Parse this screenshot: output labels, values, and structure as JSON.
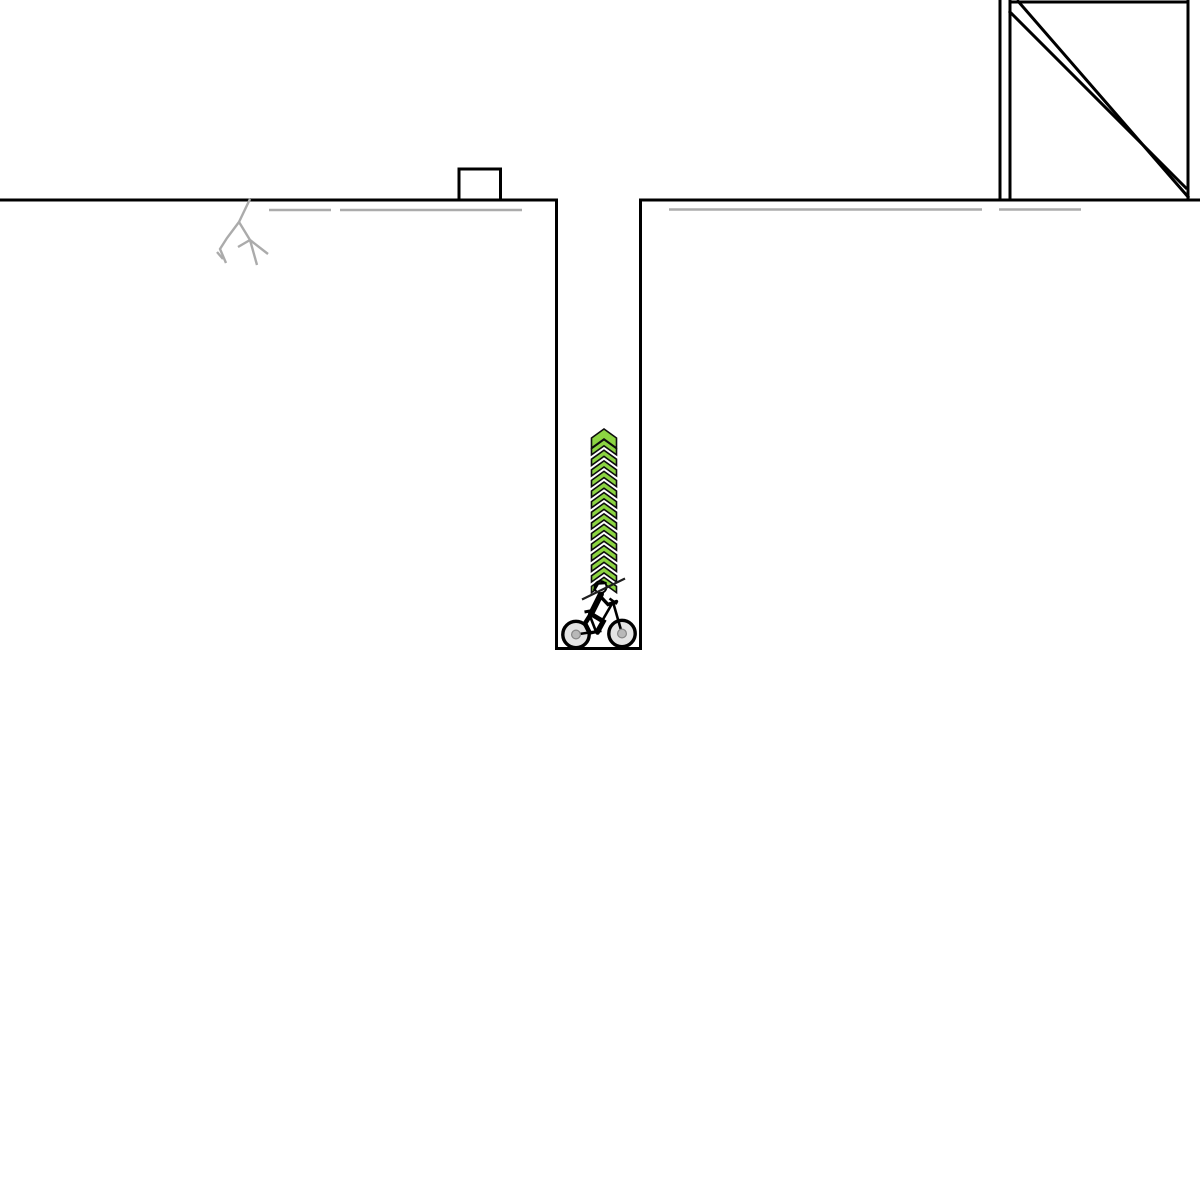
{
  "canvas": {
    "width": 1200,
    "height": 1200,
    "background": "#ffffff"
  },
  "palette": {
    "track_black": "#000000",
    "scenery_gray": "#ababab",
    "boost_green": "#8cd442",
    "boost_outline": "#0d0d0d",
    "wheel_inner": "#e4e4e4",
    "wheel_hub": "#b8b8b8",
    "wheel_hub_ring": "#878787",
    "helmet_white": "#ffffff"
  },
  "scene": {
    "elements": [
      {
        "name": "terrain-ground-and-pit",
        "type": "polyline",
        "points": [
          [
            0,
            200
          ],
          [
            556.5,
            200
          ],
          [
            556.5,
            648.5
          ],
          [
            640.5,
            648.5
          ],
          [
            640.5,
            200
          ],
          [
            1200,
            200
          ]
        ],
        "stroke": "#000000",
        "width": 3
      },
      {
        "name": "obstacle-box",
        "type": "rect",
        "x": 459,
        "y": 169,
        "w": 41.5,
        "h": 31,
        "fill": "#ffffff",
        "stroke": "#000000",
        "width": 3
      },
      {
        "name": "ramp-structure-left-outer-post",
        "type": "polyline",
        "points": [
          [
            1000,
            0
          ],
          [
            1000,
            199
          ]
        ],
        "stroke": "#000000",
        "width": 3
      },
      {
        "name": "ramp-structure-left-inner-post",
        "type": "polyline",
        "points": [
          [
            1010,
            0
          ],
          [
            1010,
            199
          ]
        ],
        "stroke": "#000000",
        "width": 3
      },
      {
        "name": "ramp-structure-right-post",
        "type": "polyline",
        "points": [
          [
            1188,
            0
          ],
          [
            1188,
            199
          ]
        ],
        "stroke": "#000000",
        "width": 3
      },
      {
        "name": "ramp-structure-top-beam",
        "type": "polyline",
        "points": [
          [
            1009,
            2
          ],
          [
            1188,
            2
          ]
        ],
        "stroke": "#000000",
        "width": 3
      },
      {
        "name": "ramp-structure-diagonal-outer",
        "type": "polyline",
        "points": [
          [
            1017,
            0
          ],
          [
            1189,
            198
          ]
        ],
        "stroke": "#000000",
        "width": 3
      },
      {
        "name": "ramp-structure-diagonal-inner",
        "type": "polyline",
        "points": [
          [
            1009,
            11
          ],
          [
            1187,
            189
          ]
        ],
        "stroke": "#000000",
        "width": 3
      },
      {
        "name": "scenery-line-left-a",
        "type": "polyline",
        "points": [
          [
            269,
            210
          ],
          [
            331,
            210
          ]
        ],
        "stroke": "#ababab",
        "width": 2.6
      },
      {
        "name": "scenery-line-left-b",
        "type": "polyline",
        "points": [
          [
            340,
            210
          ],
          [
            522,
            210
          ]
        ],
        "stroke": "#ababab",
        "width": 2.6
      },
      {
        "name": "scenery-line-right-a",
        "type": "polyline",
        "points": [
          [
            669,
            209.5
          ],
          [
            982,
            209.5
          ]
        ],
        "stroke": "#ababab",
        "width": 2.6
      },
      {
        "name": "scenery-line-right-b",
        "type": "polyline",
        "points": [
          [
            999,
            209.5
          ],
          [
            1081,
            209.5
          ]
        ],
        "stroke": "#ababab",
        "width": 2.6
      },
      {
        "name": "scenery-crack-main",
        "type": "polyline",
        "points": [
          [
            250,
            199
          ],
          [
            239,
            222
          ],
          [
            227,
            238
          ],
          [
            220,
            249
          ],
          [
            226,
            263
          ]
        ],
        "stroke": "#ababab",
        "width": 2.4
      },
      {
        "name": "scenery-crack-tick",
        "type": "polyline",
        "points": [
          [
            217,
            252
          ],
          [
            223,
            259
          ]
        ],
        "stroke": "#ababab",
        "width": 2.4
      },
      {
        "name": "scenery-crack-branch",
        "type": "polyline",
        "points": [
          [
            239,
            222
          ],
          [
            250,
            240
          ],
          [
            257,
            265
          ]
        ],
        "stroke": "#ababab",
        "width": 2.4
      },
      {
        "name": "scenery-crack-branch-left",
        "type": "polyline",
        "points": [
          [
            250,
            240
          ],
          [
            238,
            247
          ]
        ],
        "stroke": "#ababab",
        "width": 2.4
      },
      {
        "name": "scenery-crack-branch-right",
        "type": "polyline",
        "points": [
          [
            250,
            240
          ],
          [
            268,
            254
          ]
        ],
        "stroke": "#ababab",
        "width": 2.4
      },
      {
        "name": "boost-arrows",
        "type": "chevron-stack",
        "cx": 604,
        "top": 429,
        "count": 15,
        "period": 10.6,
        "half_width": 12.5,
        "rise": 9,
        "thickness": 6.2,
        "first_thickness": 10,
        "fill": "#8cd442",
        "stroke": "#0d0d0d",
        "stroke_width": 1.6
      },
      {
        "name": "bike-rear-wheel-tire",
        "type": "circle",
        "cx": 576,
        "cy": 634.5,
        "r": 13.2,
        "fill": "#e4e4e4",
        "stroke": "#000000",
        "width": 3.4
      },
      {
        "name": "bike-front-wheel-tire",
        "type": "circle",
        "cx": 622,
        "cy": 633.5,
        "r": 13.2,
        "fill": "#e4e4e4",
        "stroke": "#000000",
        "width": 3.4
      },
      {
        "name": "bike-chainstay-seat-tube",
        "type": "polyline",
        "points": [
          [
            576,
            634.5
          ],
          [
            596,
            631.5
          ],
          [
            589,
            613.5
          ]
        ],
        "stroke": "#000000",
        "width": 2.6
      },
      {
        "name": "bike-down-tube",
        "type": "polyline",
        "points": [
          [
            596,
            631.5
          ],
          [
            613,
            602
          ]
        ],
        "stroke": "#000000",
        "width": 2.6
      },
      {
        "name": "bike-fork",
        "type": "polyline",
        "points": [
          [
            613,
            602
          ],
          [
            622,
            633.5
          ]
        ],
        "stroke": "#000000",
        "width": 2.6
      },
      {
        "name": "bike-handlebar",
        "type": "polyline",
        "points": [
          [
            609.5,
            598.5
          ],
          [
            617,
            604
          ]
        ],
        "stroke": "#000000",
        "width": 2.6
      },
      {
        "name": "bike-seat",
        "type": "polyline",
        "points": [
          [
            584.5,
            612
          ],
          [
            592.5,
            610.5
          ]
        ],
        "stroke": "#000000",
        "width": 3
      },
      {
        "name": "bike-crank",
        "type": "polyline",
        "points": [
          [
            590,
            633.5
          ],
          [
            601.5,
            631
          ]
        ],
        "stroke": "#000000",
        "width": 2.2
      },
      {
        "name": "bike-rear-hub",
        "type": "circle",
        "cx": 576,
        "cy": 634.5,
        "r": 4.4,
        "fill": "#b8b8b8",
        "stroke": "#878787",
        "width": 1.2
      },
      {
        "name": "bike-front-hub",
        "type": "circle",
        "cx": 622,
        "cy": 633.5,
        "r": 4.4,
        "fill": "#b8b8b8",
        "stroke": "#878787",
        "width": 1.2
      },
      {
        "name": "rider-torso",
        "type": "polyline",
        "points": [
          [
            601,
            594
          ],
          [
            591,
            614
          ]
        ],
        "stroke": "#000000",
        "width": 6,
        "cap": "round"
      },
      {
        "name": "rider-arm",
        "type": "polyline",
        "points": [
          [
            600,
            596
          ],
          [
            608,
            604.5
          ],
          [
            616.5,
            601.5
          ]
        ],
        "stroke": "#000000",
        "width": 3.4,
        "cap": "round"
      },
      {
        "name": "rider-front-leg",
        "type": "polyline",
        "points": [
          [
            591,
            614
          ],
          [
            603.5,
            621.5
          ],
          [
            597.5,
            632.5
          ]
        ],
        "stroke": "#000000",
        "width": 4.6,
        "cap": "round"
      },
      {
        "name": "rider-rear-leg",
        "type": "polyline",
        "points": [
          [
            591,
            614
          ],
          [
            585,
            623.5
          ],
          [
            589.5,
            632.5
          ]
        ],
        "stroke": "#000000",
        "width": 4.6,
        "cap": "round"
      },
      {
        "name": "rider-head",
        "type": "circle",
        "cx": 600.5,
        "cy": 587,
        "r": 6,
        "fill": "#ffffff",
        "stroke": "#000000",
        "width": 1.8
      },
      {
        "name": "rider-helmet",
        "type": "polyline",
        "points": [
          [
            594.5,
            589.5
          ],
          [
            598,
            583.5
          ],
          [
            605.5,
            583
          ]
        ],
        "stroke": "#000000",
        "width": 2.6,
        "cap": "round"
      },
      {
        "name": "track-short-diagonal-line",
        "type": "polyline",
        "points": [
          [
            582,
            599.5
          ],
          [
            625,
            578.5
          ]
        ],
        "stroke": "#1f1f1f",
        "width": 2.2
      }
    ]
  }
}
